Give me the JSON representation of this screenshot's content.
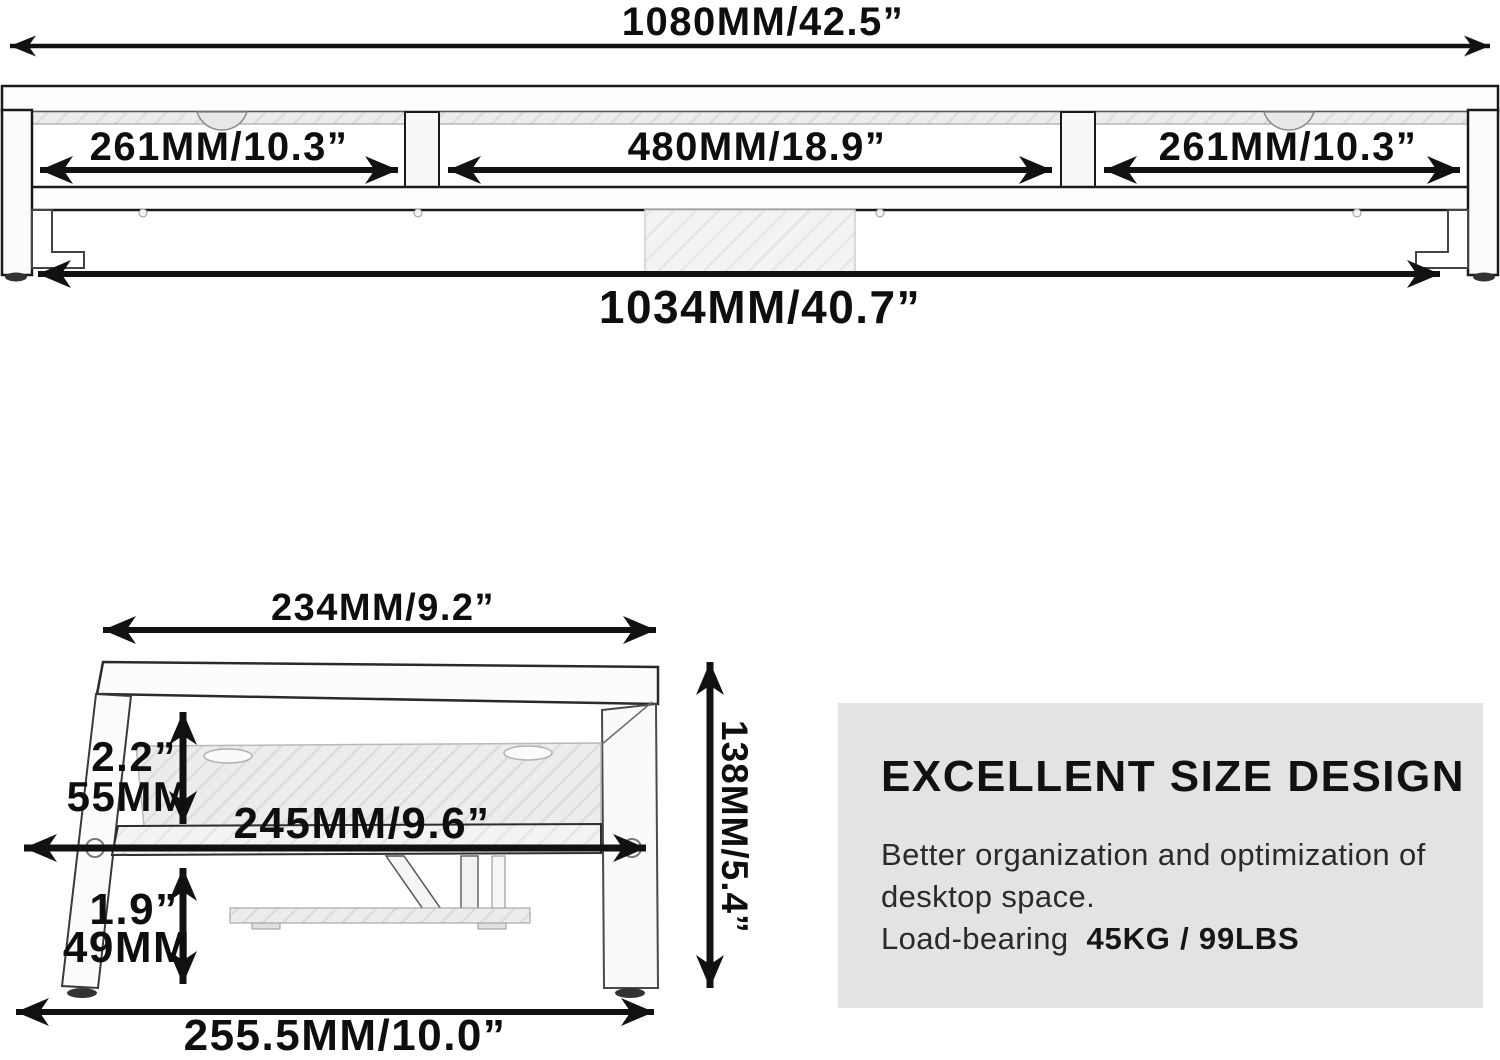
{
  "front_view": {
    "total_width": "1080MM/42.5”",
    "section_left": "261MM/10.3”",
    "section_middle": "480MM/18.9”",
    "section_right": "261MM/10.3”",
    "inner_width": "1034MM/40.7”"
  },
  "side_view": {
    "top_width": "234MM/9.2”",
    "shelf_clearance_in": "2.2”",
    "shelf_clearance_mm": "55MM",
    "middle_width": "245MM/9.6”",
    "base_clearance_in": "1.9”",
    "base_clearance_mm": "49MM",
    "bottom_width": "255.5MM/10.0”",
    "total_height": "138MM/5.4”"
  },
  "info_panel": {
    "heading": "EXCELLENT SIZE DESIGN",
    "body_line1": "Better organization and optimization of",
    "body_line2": "desktop space.",
    "load_label": "Load-bearing",
    "load_value": "45KG / 99LBS"
  },
  "colors": {
    "ink": "#111111",
    "panel_bg": "#e3e3e3",
    "hatch_fill": "#ececec"
  }
}
